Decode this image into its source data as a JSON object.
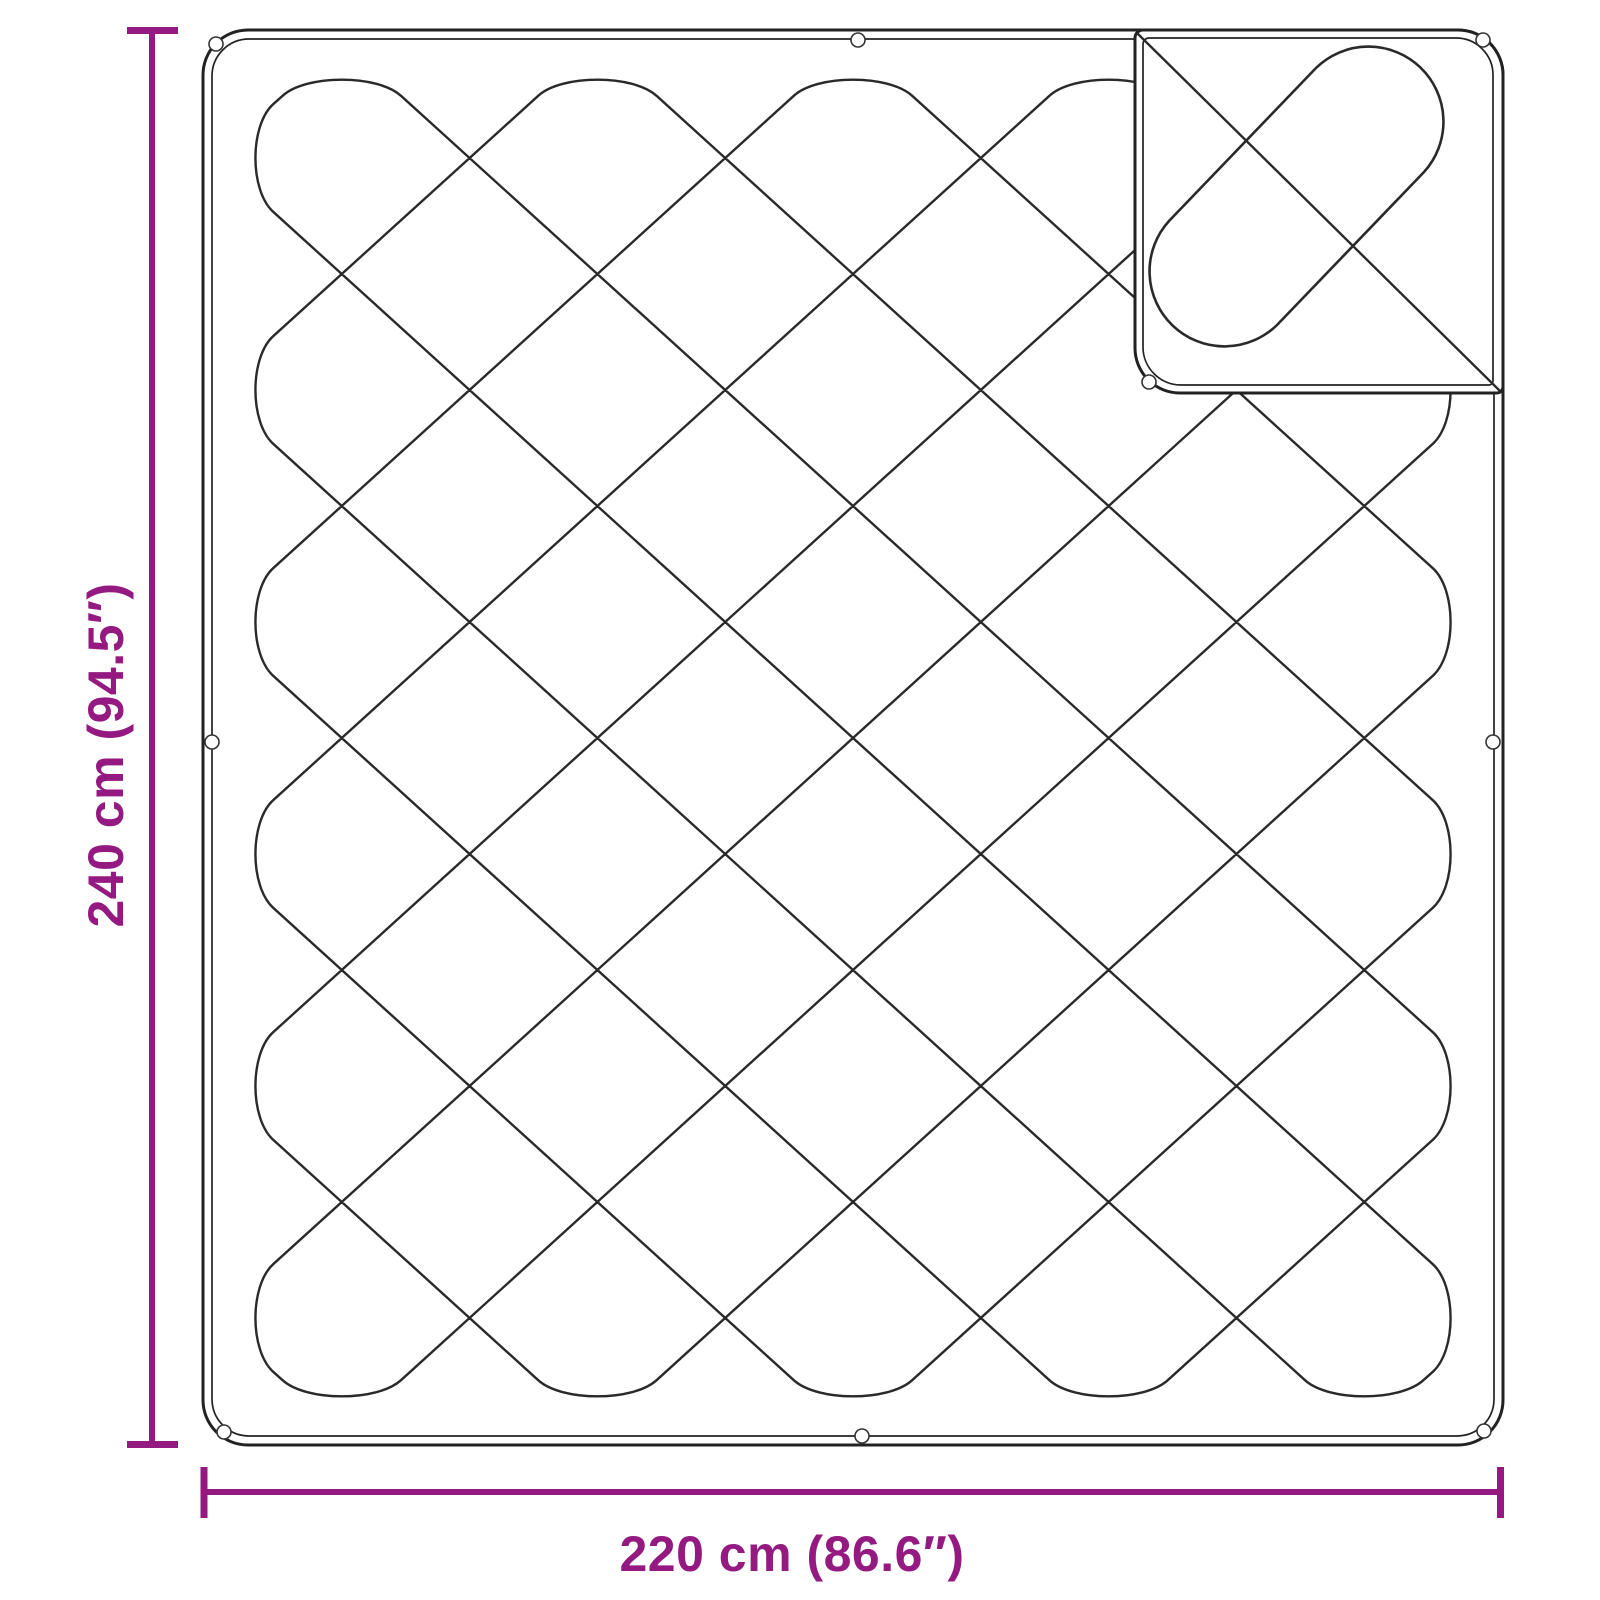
{
  "diagram": {
    "title": "Quilted blanket with folded-back corner — dimension drawing",
    "height_dimension": {
      "label": "240 cm (94.5″)",
      "cm": 240,
      "inches": 94.5
    },
    "width_dimension": {
      "label": "220 cm (86.6″)",
      "cm": 220,
      "inches": 86.6
    },
    "quilt_grid": {
      "columns": 5,
      "rows": 6
    },
    "eyelets_visible": 9,
    "colors": {
      "dimension_accent": "#941a82",
      "outline": "#222222",
      "background": "#ffffff"
    }
  }
}
